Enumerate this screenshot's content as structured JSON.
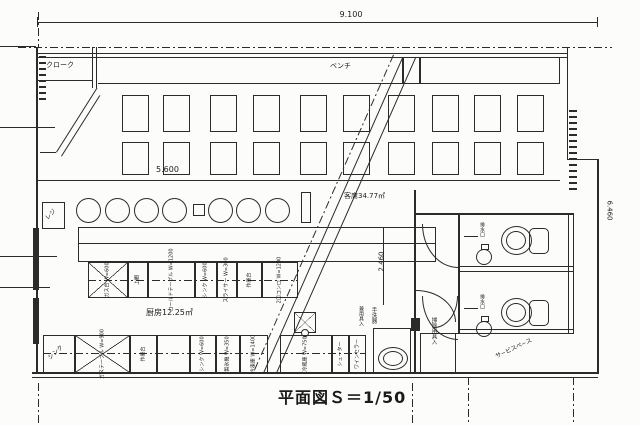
{
  "title": "平面図Ｓ＝1/50",
  "dims": {
    "top": "9.100",
    "right": "6.460",
    "mid": "5.600",
    "corridor": "2.460"
  },
  "labels": {
    "cloak": "クローク",
    "bench": "ベンチ",
    "seating": "客席34.77㎡",
    "kitchen": "厨房12.25㎡",
    "register": "レジ",
    "corner_sink": "シンク",
    "service_space": "サ−ビスペ−ス",
    "cleaning_closet": "掃除用具入",
    "handwash": "手洗器",
    "handwash_sub": "兼用具入",
    "drain_1": "排水口",
    "drain_2": "排水口"
  },
  "equipment_row1": [
    {
      "label": "ガス台 W=600"
    },
    {
      "label": "上棚"
    },
    {
      "label": "コールドテーブル W=1200"
    },
    {
      "label": "シンク W=600"
    },
    {
      "label": "スライサー W=300"
    },
    {
      "label": "作業台"
    },
    {
      "label": "2口コンロ W=1200"
    }
  ],
  "equipment_row2": [
    {
      "label": "ガステーブル W=900"
    },
    {
      "label": "作業台"
    },
    {
      "label": "シンク W=600"
    },
    {
      "label": "製氷機 W=350"
    },
    {
      "label": "冷凍庫 W=1400"
    },
    {
      "label": "冷蔵庫 W=750"
    },
    {
      "label": "シューター"
    },
    {
      "label": "ワインセラー"
    }
  ]
}
